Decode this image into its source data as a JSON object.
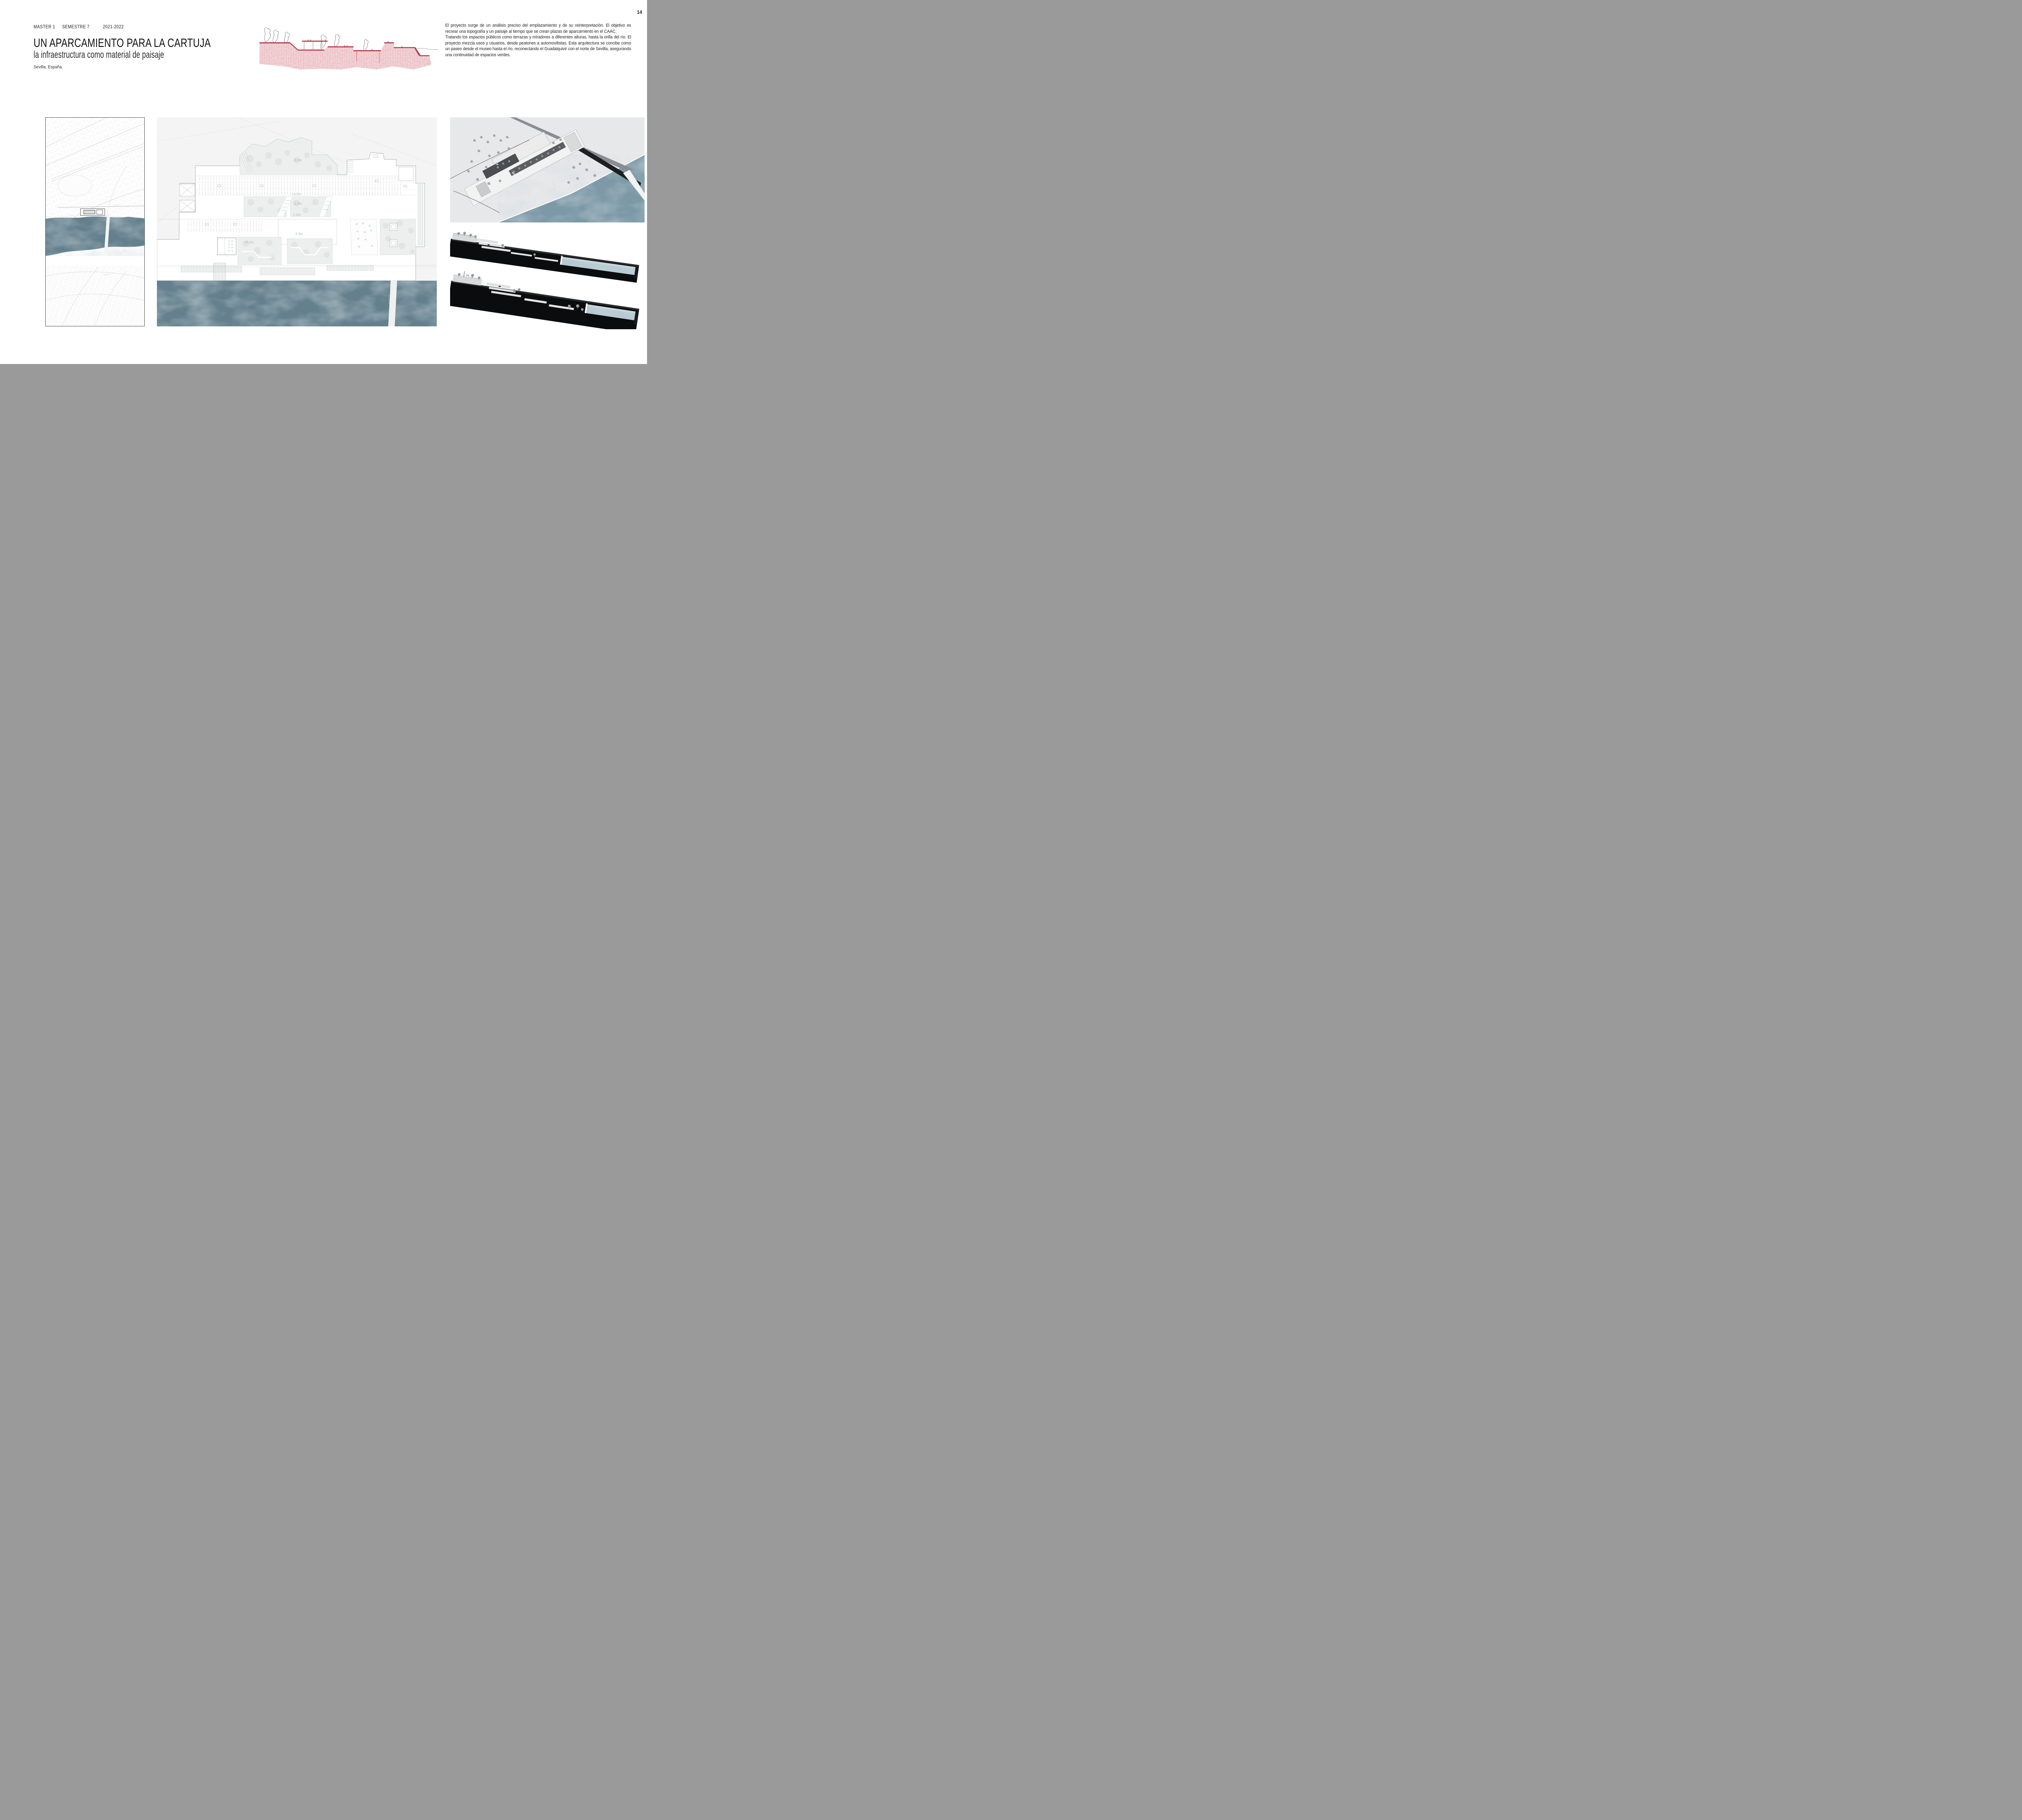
{
  "page": {
    "number": "14"
  },
  "header": {
    "course": "MASTER 1",
    "semester": "SEMESTRE 7",
    "year": "2021-2022"
  },
  "title": {
    "main": "UN APARCAMIENTO PARA LA CARTUJA",
    "subtitle": "la infraestructura como material de paisaje",
    "location": "Sevilla, España."
  },
  "description": {
    "para1": "El proyecto surge de un análisis preciso del emplazamiento y de su reinterpretación. El objetivo es recrear una topografía y un paisaje al tiempo que se crean plazas de aparcamiento en el CAAC.",
    "para2": "Tratando los espacios públicos como terrazas y miradores a diferentes alturas, hasta la orilla del río. El proyecto mezcla usos y usuarios, desde peatones a automovilistas. Esta arquitectura se concibe como un paseo desde el museo hasta el río, reconectando el Guadalquivir con el norte de Sevilla, asegurando una continuidad de espacios verdes."
  },
  "plan": {
    "levels": [
      "-2.0m",
      "+1.0m",
      "-2.0m",
      "-1.0m",
      "-0.5m",
      "+0.0m"
    ],
    "bridge_label": "PUENTE"
  },
  "map": {
    "street_labels": [
      "PASEO",
      "CALLE",
      "TORNEO"
    ]
  },
  "colors": {
    "river": "#64808d",
    "water_light": "#b5c8d1",
    "sketch_red": "#c04553",
    "axon_background": "#e7e8e9",
    "ink": "#1c1c1c"
  }
}
